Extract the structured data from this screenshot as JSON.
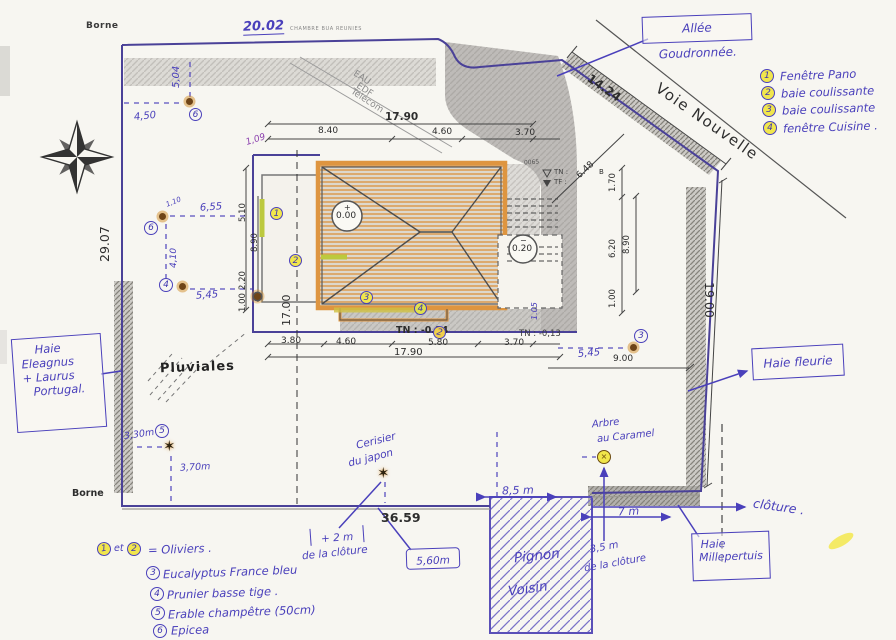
{
  "printed": {
    "borne_top": "Borne",
    "borne_bottom": "Borne",
    "tiny_print": "CHAMBRE BUA REUNIES",
    "eau": "EAU",
    "edf": "EDF",
    "telecom": "Télécom",
    "voie_nouvelle": "Voie Nouvelle",
    "pluviales": "Pluviales",
    "parcel_num": "0065",
    "tn_label": "TN :",
    "tf_label": "TF :",
    "point_b": "B",
    "tn_014": "TN : -0.14",
    "tn_013": "TN : -0,13",
    "lvl_0_sign": "+",
    "lvl_0": "0.00",
    "lvl_20_sign": "−",
    "lvl_20": "0.20"
  },
  "dims": {
    "north": "20.02",
    "west": "29.07",
    "northeast": "14.24",
    "east": "19.00",
    "south": "36.59",
    "east_inner": "9.00",
    "top_total": "17.90",
    "top_a": "8.40",
    "top_b": "4.60",
    "top_c": "3.70",
    "bottom_a": "3.80",
    "bottom_b": "4.60",
    "bottom_c": "5.80",
    "bottom_d": "3.70",
    "bottom_total": "17.90",
    "left_1": "5.10",
    "left_2": "8.90",
    "left_3": "2.20",
    "left_4": "1.00",
    "left_total": "17.00",
    "right_1": "1.70",
    "right_2": "6.20",
    "right_3": "8.90",
    "right_4": "1.00",
    "right_diag": "6.48",
    "right_105": "1.05"
  },
  "handwritten": {
    "allee": "Allée Goudronnée.",
    "d_504": "5,04",
    "d_450": "4,50",
    "d_110": "1,10",
    "d_655": "6,55",
    "d_410": "4,10",
    "d_545l": "5,45",
    "d_545r": "5,45",
    "d_109": "1,09",
    "d_330": "3,30m",
    "d_370": "3,70m",
    "haie_left_1": "Haie",
    "haie_left_2": "Eleagnus",
    "haie_left_3": "+ Laurus",
    "haie_left_4": "Portugal.",
    "haie_fleurie": "Haie fleurie",
    "haie_mp_1": "Haie",
    "haie_mp_2": "Millepertuis",
    "cloture": "clôture .",
    "pignon_1": "Pignon",
    "pignon_2": "Voisin",
    "cerisier_1": "Cerisier",
    "cerisier_2": "du japon",
    "caramel_1": "Arbre",
    "caramel_2": "au Caramel",
    "plus2m": "+ 2 m",
    "plus2m_b": "de la clôture",
    "d_560": "5,60m",
    "d_85": "8,5 m",
    "d_7": "7 m",
    "d_35": "3,5 m",
    "d_35_b": "de la clôture"
  },
  "window_legend": [
    {
      "num": "1",
      "label": "Fenêtre Pano"
    },
    {
      "num": "2",
      "label": "baie coulissante"
    },
    {
      "num": "3",
      "label": "baie coulissante"
    },
    {
      "num": "4",
      "label": "fenêtre Cuisine ."
    }
  ],
  "tree_legend": {
    "r1_n1": "1",
    "r1_et": "et",
    "r1_n2": "2",
    "r1_label": "= Oliviers .",
    "rows": [
      {
        "num": "3",
        "label": "Eucalyptus France bleu"
      },
      {
        "num": "4",
        "label": "Prunier basse tige ."
      },
      {
        "num": "5",
        "label": "Erable champêtre (50cm)"
      },
      {
        "num": "6",
        "label": "Epicea"
      }
    ]
  },
  "markers": {
    "w1": "1",
    "w2": "2",
    "w3": "3",
    "w4": "4",
    "w2b": "2",
    "t6a": "6",
    "t6b": "6",
    "t4": "4",
    "t5": "5",
    "t3": "3"
  },
  "colors": {
    "ink_blue": "#4a40bb",
    "boundary_purple": "#4a4198",
    "roof_orange": "#de9540",
    "highlight_yellow": "#f1e64d",
    "pencil_gray": "#b7b5b1"
  }
}
